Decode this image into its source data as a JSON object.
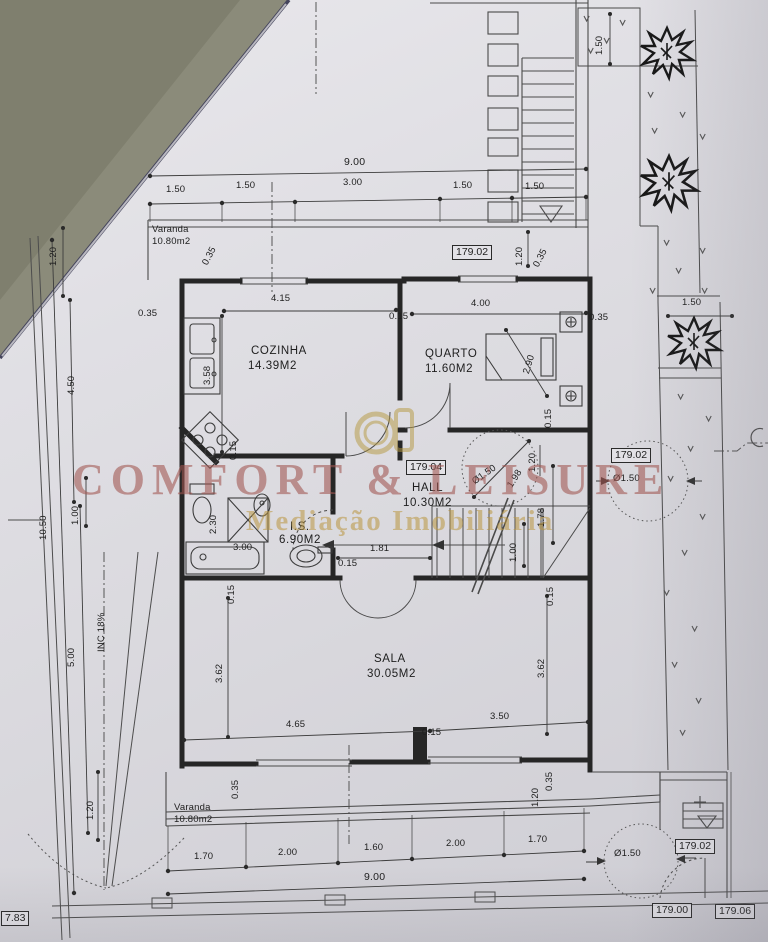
{
  "watermark": {
    "brand": "COMFORT & LEISURE",
    "tagline": "Mediação Imobiliária"
  },
  "rooms": {
    "cozinha": {
      "name": "COZINHA",
      "area": "14.39M2"
    },
    "quarto": {
      "name": "QUARTO",
      "area": "11.60M2"
    },
    "hall": {
      "name": "HALL",
      "area": "10.30M2"
    },
    "is": {
      "name": "I.S.",
      "area": "6.90M2"
    },
    "sala": {
      "name": "SALA",
      "area": "30.05M2"
    },
    "varanda_top": {
      "name": "Varanda",
      "area": "10.80m2"
    },
    "varanda_bottom": {
      "name": "Varanda",
      "area": "10.80m2"
    }
  },
  "levels": {
    "top": "179.02",
    "hall": "179.04",
    "right": "179.02",
    "entrance": "179.02",
    "street_a": "179.00",
    "street_b": "179.06",
    "corner": "7.83"
  },
  "dims": {
    "top_total": "9.00",
    "top_chain": [
      "1.50",
      "1.50",
      "3.00",
      "1.50",
      "1.50"
    ],
    "varanda_depth": "1.20",
    "wall_top_left": "0.35",
    "wall_top_right": "0.35",
    "garden_top": "1.50",
    "garden_tree": "1.50",
    "left_a": "1.20",
    "left_b": "4.50",
    "left_total": "10.50",
    "left_c": "1.00",
    "left_d": "5.00",
    "left_e": "1.20",
    "left_wall": "0.35",
    "ramp": "INC 18%",
    "cozinha_w": "4.15",
    "cozinha_h": "3.58",
    "cozinha_wall": "0.15",
    "cozinha_corner": "0.15",
    "quarto_w": "4.00",
    "quarto_bed": "2.90",
    "quarto_wall": "0.35",
    "quarto_door": "0.15",
    "hall_w": "1.81",
    "hall_wall": "0.15",
    "hall_land": "1.20",
    "hall_c1": "Ø1.50",
    "hall_c2": "1.98",
    "stair_a": "1.78",
    "stair_b": "1.00",
    "stair_wall": "0.15",
    "is_h": "2.30",
    "is_w": "3.00",
    "sala_hl": "3.62",
    "sala_hr": "3.62",
    "sala_wl": "4.65",
    "sala_wr": "3.50",
    "sala_wall": "0.15",
    "sala_tl": "0.15",
    "sala_bl": "0.35",
    "sala_br": "0.35",
    "sala_corner": "1.20",
    "bottom_chain": [
      "1.70",
      "2.00",
      "1.60",
      "2.00",
      "1.70"
    ],
    "bottom_total": "9.00",
    "circle_right": "Ø1.50",
    "circle_bottom": "Ø1.50"
  }
}
